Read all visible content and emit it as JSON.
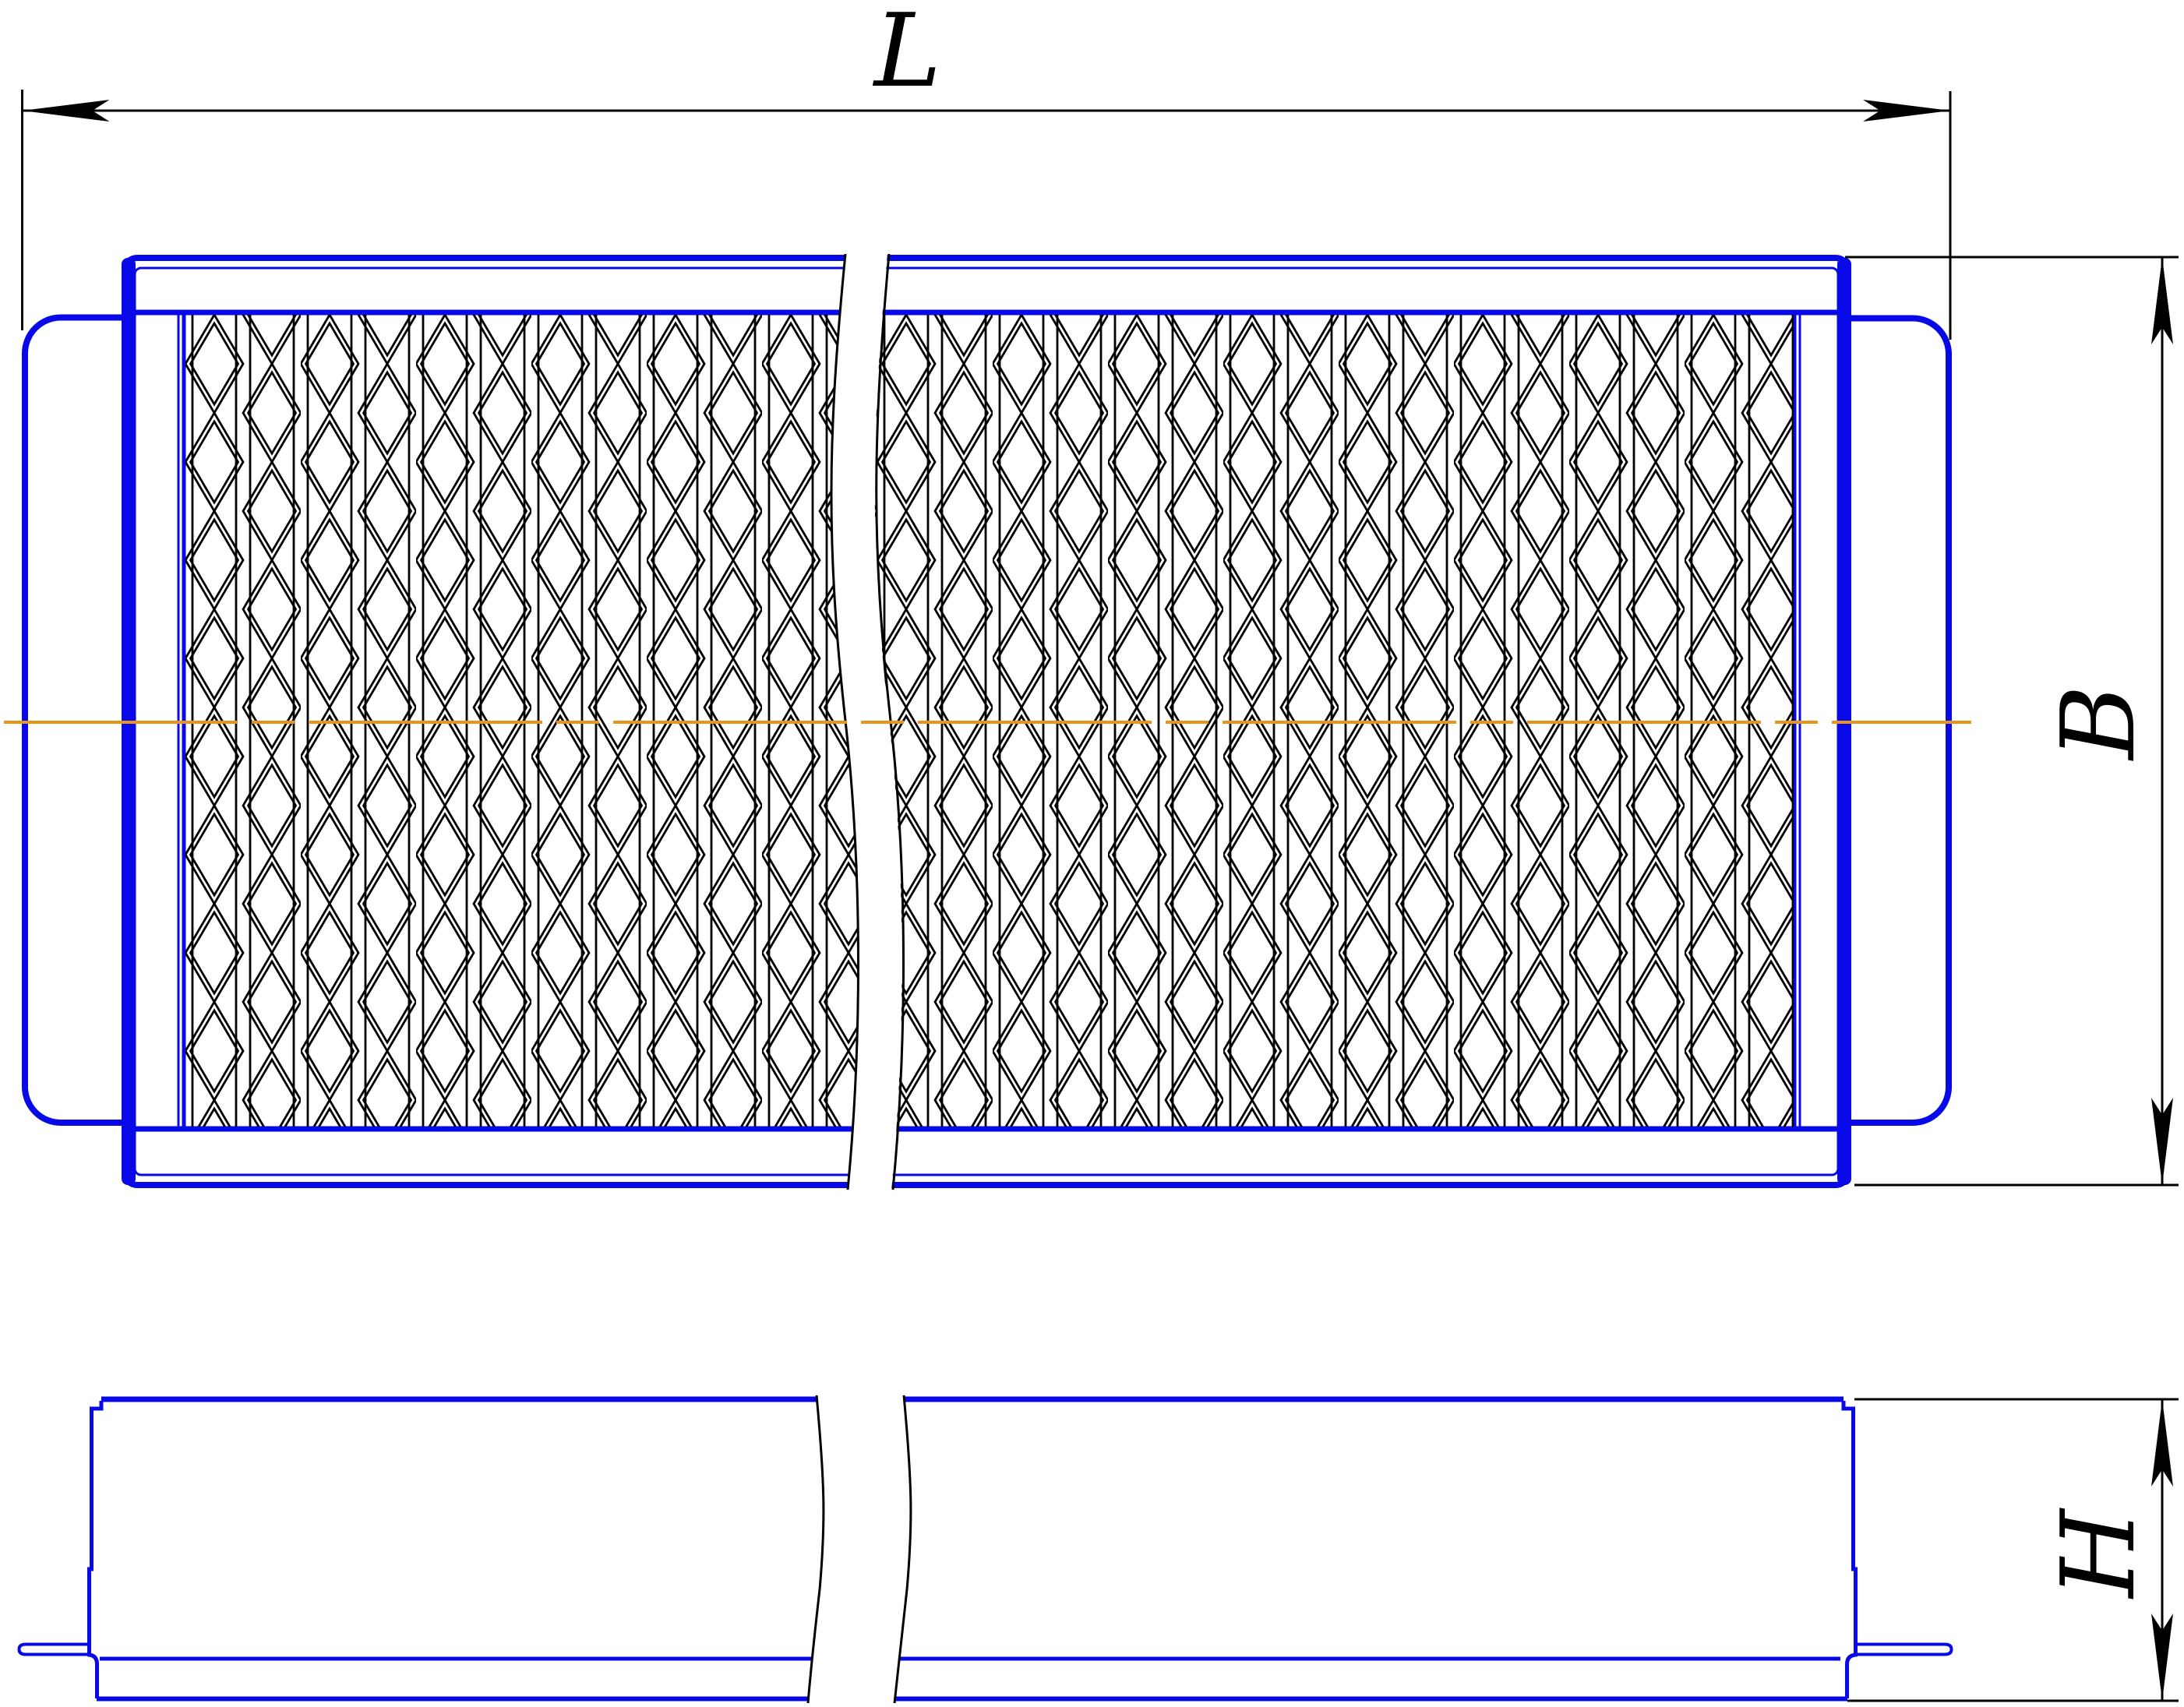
{
  "drawing": {
    "type": "technical-drawing-filter-element",
    "dimensions": {
      "length_label": "L",
      "width_label": "B",
      "height_label": "H"
    }
  },
  "colors": {
    "part": "#0909e8",
    "center": "#e8941b",
    "annot": "#000000",
    "bg": "#ffffff"
  }
}
